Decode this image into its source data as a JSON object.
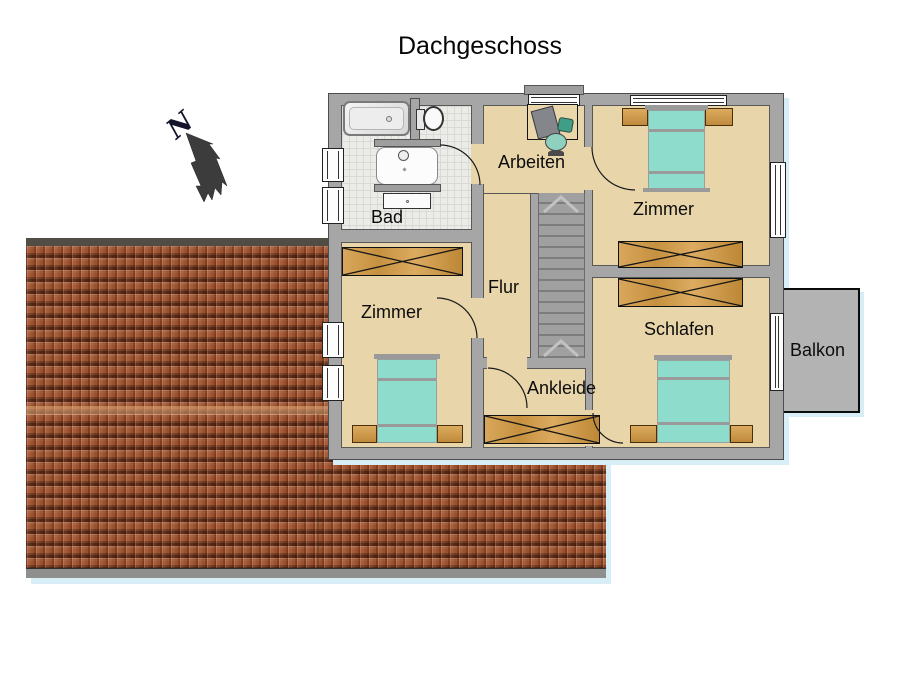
{
  "header": {
    "title": "Dachgeschoss"
  },
  "compass": {
    "label": "N",
    "direction": "north-west-arrow"
  },
  "rooms": {
    "bad": {
      "label": "Bad"
    },
    "arbeiten": {
      "label": "Arbeiten"
    },
    "zimmer_top": {
      "label": "Zimmer"
    },
    "flur": {
      "label": "Flur"
    },
    "zimmer_left": {
      "label": "Zimmer"
    },
    "schlafen": {
      "label": "Schlafen"
    },
    "ankleide": {
      "label": "Ankleide"
    },
    "balkon": {
      "label": "Balkon"
    }
  },
  "furniture_icons": [
    "bathtub",
    "toilet",
    "washbasin",
    "vanity-cabinet",
    "desk",
    "office-chair",
    "staircase",
    "wardrobe",
    "double-bed",
    "nightstand",
    "window",
    "door-arc"
  ],
  "colors": {
    "floor_tan": "#e8d6aa",
    "bath_tile": "#ebebe8",
    "wall_gray": "#a6a6a6",
    "mattress_teal": "#8edccb",
    "wood": "#cf9a4e",
    "roof_terracotta": "#a0532e",
    "balcony_gray": "#b3b3b3",
    "shadow_blue": "#d8eef6"
  }
}
